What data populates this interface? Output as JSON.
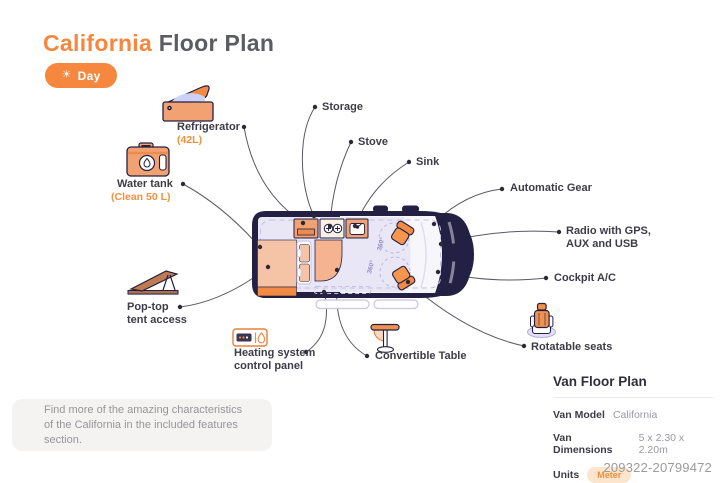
{
  "header": {
    "title_accent": "California",
    "title_rest": " Floor Plan",
    "day_toggle": {
      "label": "Day",
      "icon": "sun-icon",
      "sun_glyph": "☀"
    }
  },
  "labels": {
    "storage": "Storage",
    "refrigerator": {
      "name": "Refrigerator",
      "detail": "(42L)"
    },
    "stove": "Stove",
    "sink": "Sink",
    "water_tank": {
      "name": "Water tank",
      "detail": "(Clean 50 L)"
    },
    "automatic_gear": "Automatic Gear",
    "radio": {
      "line1": "Radio with GPS,",
      "line2": "AUX and USB"
    },
    "cockpit_ac": "Cockpit A/C",
    "pop_top": {
      "line1": "Pop-top",
      "line2": "tent access"
    },
    "heating": {
      "line1": "Heating system",
      "line2": "control panel"
    },
    "convertible_table": "Convertible Table",
    "rotatable_seats": "Rotatable seats",
    "rotation_badge": "360°"
  },
  "note": {
    "line1": "Find more of the amazing characteristics",
    "line2": "of the California in the included features section."
  },
  "details_panel": {
    "title": "Van Floor Plan",
    "rows": [
      {
        "label": "Van Model",
        "value": "California"
      },
      {
        "label": "Van Dimensions",
        "value": "5 x 2.30 x 2.20m"
      },
      {
        "label": "Units",
        "value": "Meter"
      }
    ]
  },
  "watermark": "209322-20799472",
  "colors": {
    "accent_orange": "#F5873F",
    "icon_orange_light": "#F2A172",
    "icon_orange_bright": "#F08A44",
    "van_body_navy": "#232043",
    "cabin_lavender": "#E9E6F6",
    "dashed_lavender": "#C6C0E2",
    "rotation_purple": "#978CC5",
    "leader_line_gray": "#5A5862",
    "badge_bg": "#FCE5CC"
  }
}
